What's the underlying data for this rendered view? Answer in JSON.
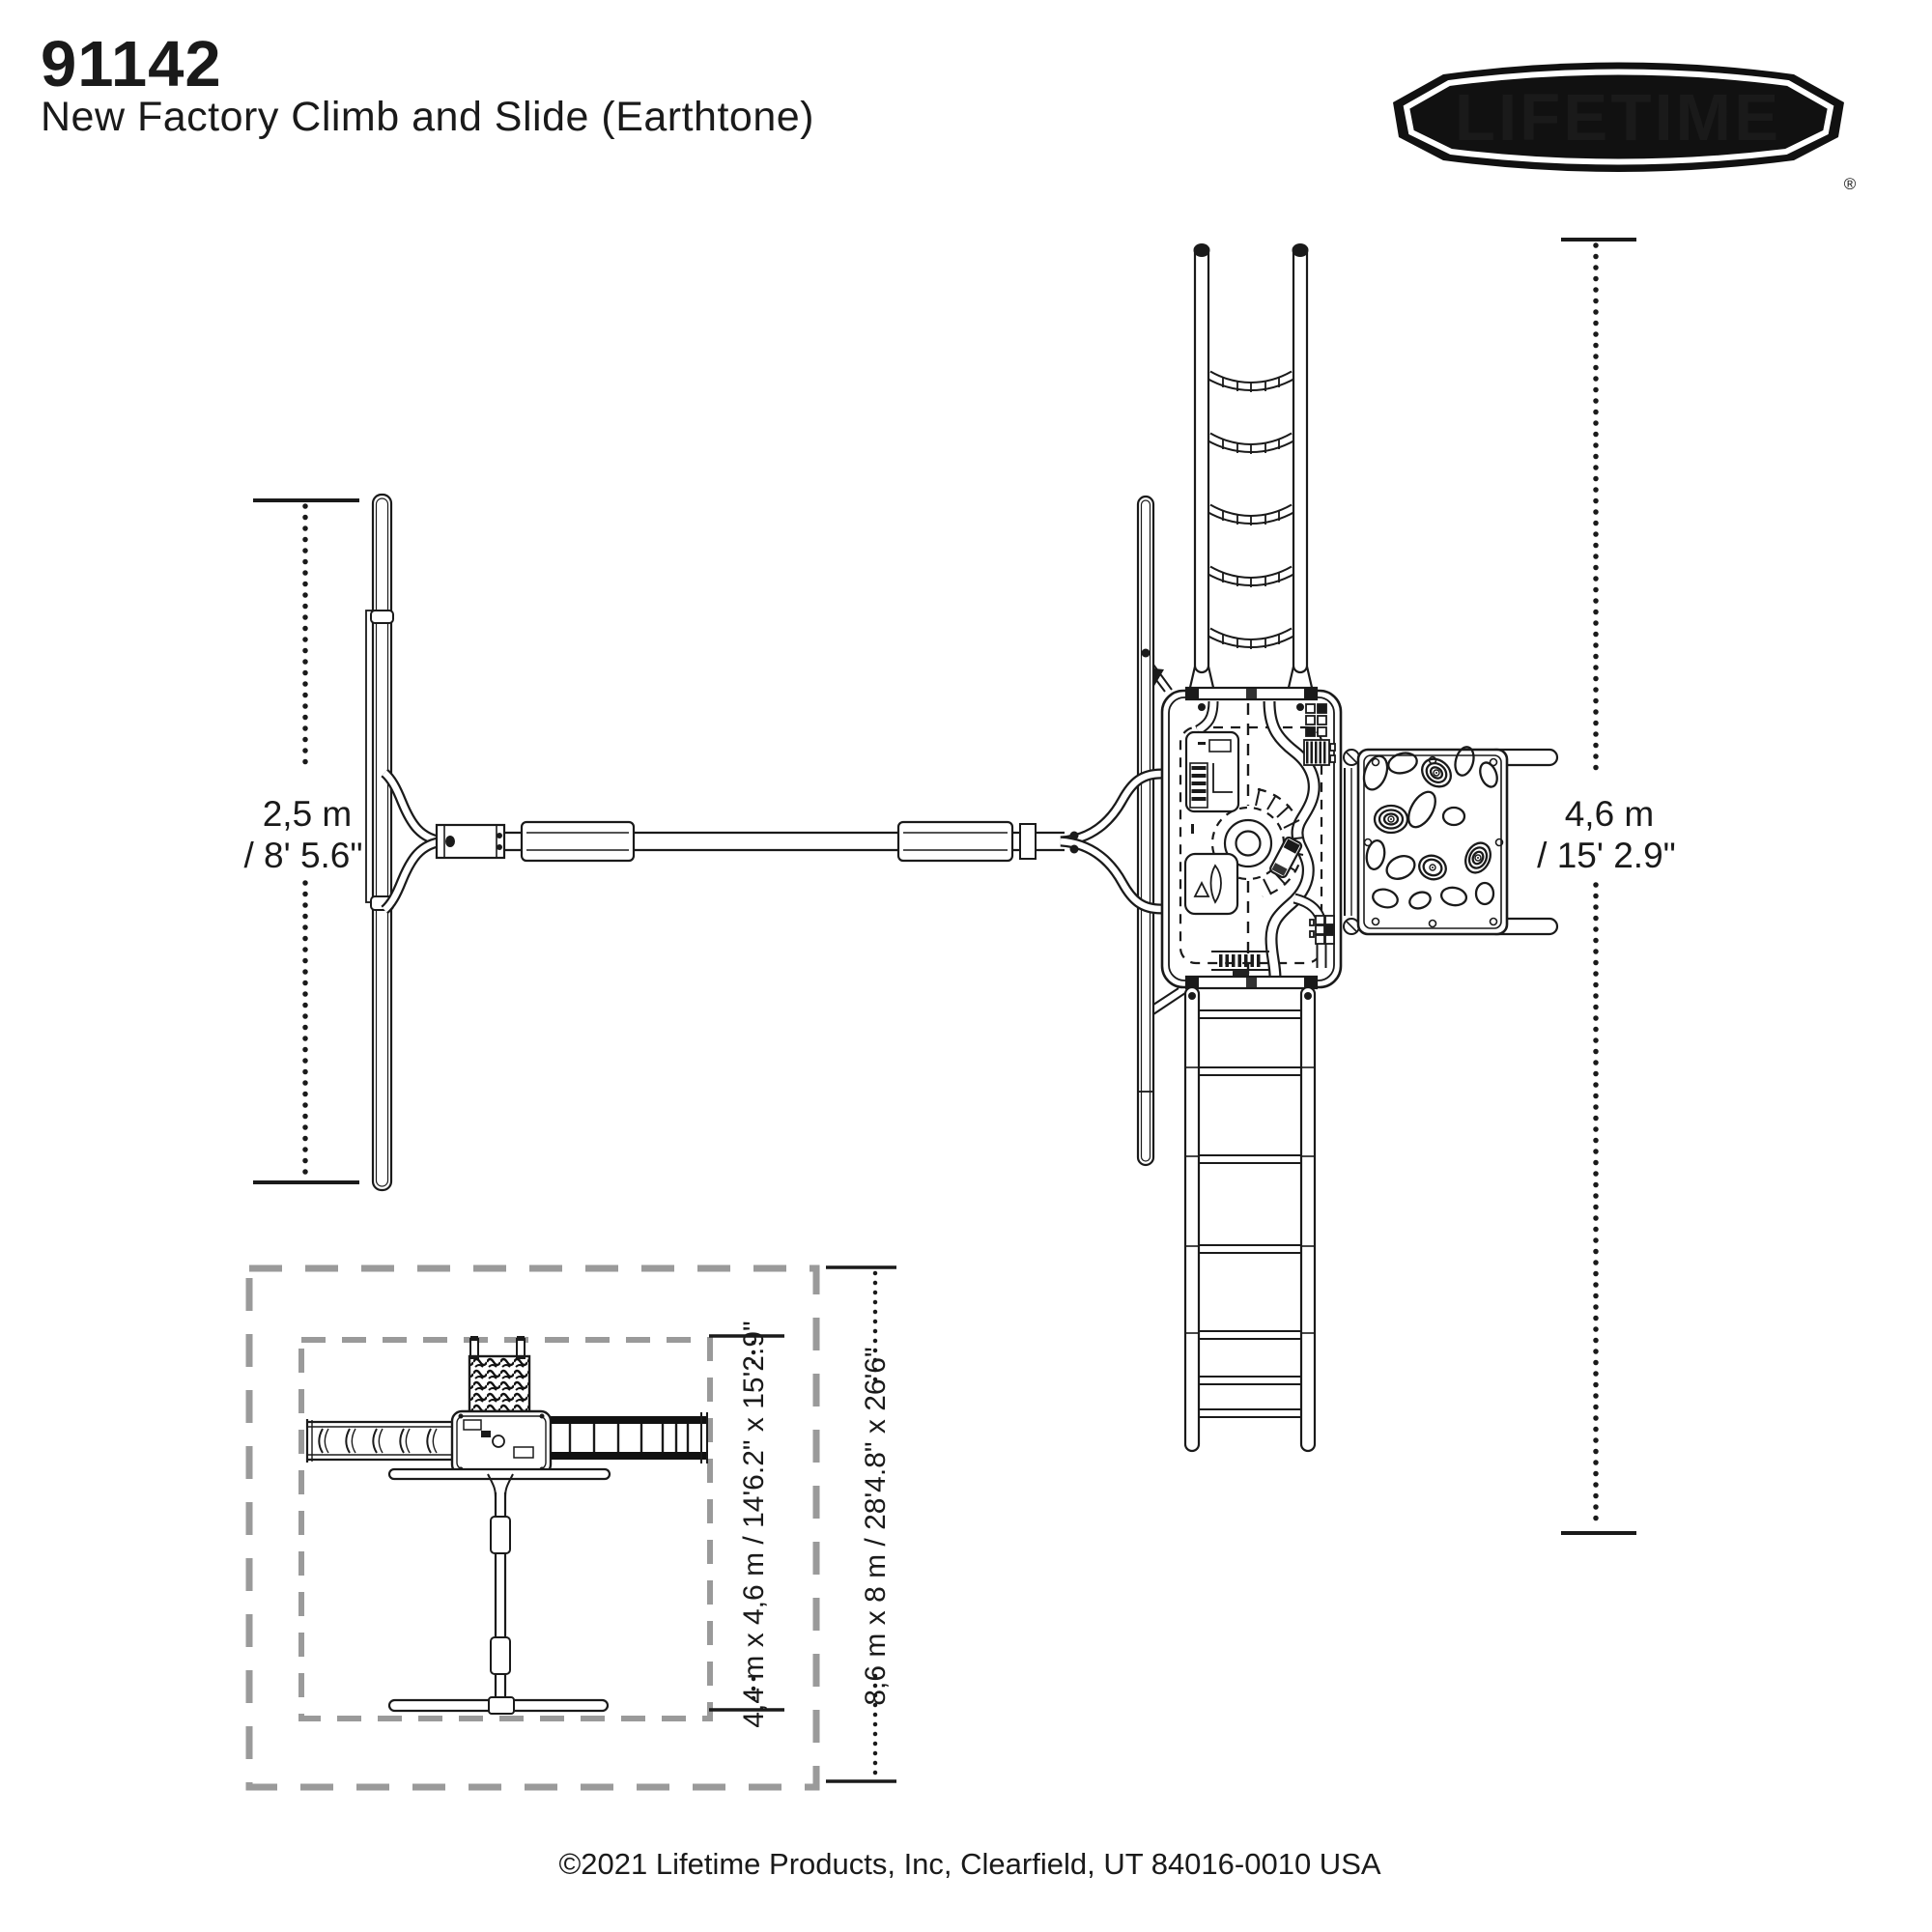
{
  "header": {
    "part_number": "91142",
    "product_name": "New Factory Climb and Slide (Earthtone)"
  },
  "logo": {
    "brand": "LIFETIME",
    "registered": "®"
  },
  "dimensions": {
    "swing_width_metric": "2,5 m",
    "swing_width_imperial": "/ 8' 5.6\"",
    "overall_length_metric": "4,6 m",
    "overall_length_imperial": "/ 15' 2.9\"",
    "footprint_label": "4,4 m x 4,6 m / 14'6.2\" x 15'2.9\"",
    "clearance_label": "8,6 m x 8 m / 28'4.8\" x 26'6\""
  },
  "footer": {
    "copyright": "©2021 Lifetime Products, Inc, Clearfield, UT 84016-0010 USA"
  },
  "colors": {
    "line": "#1a1a1a",
    "dash_gray": "#9a9a9a",
    "background": "#ffffff",
    "logo_fill": "#111111"
  }
}
